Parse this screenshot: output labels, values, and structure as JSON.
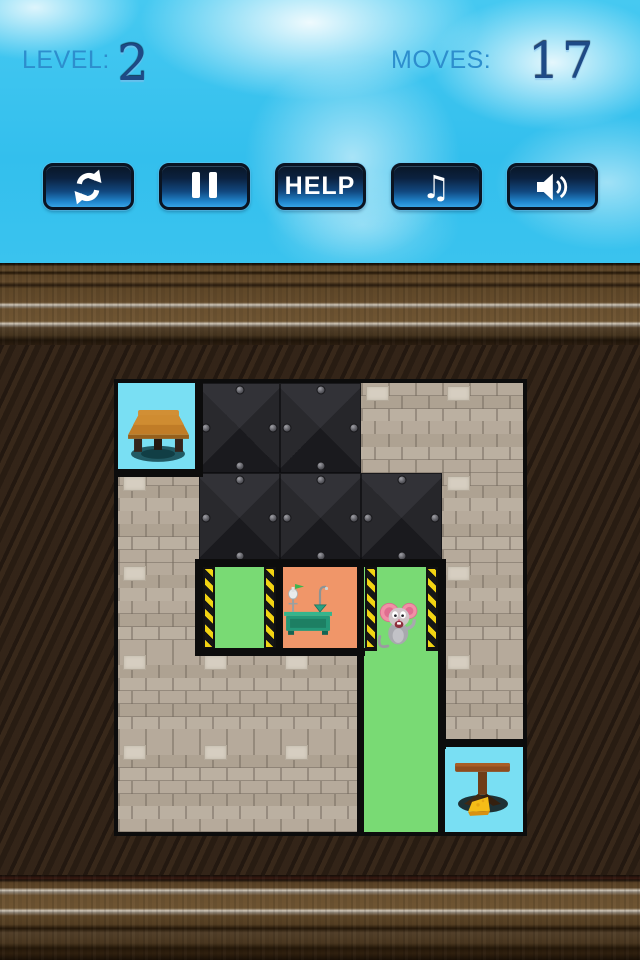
{
  "hud": {
    "level_label": "LEVEL:",
    "level_value": "2",
    "moves_label": "MOVES:",
    "moves_value": "17"
  },
  "toolbar": {
    "help_label": "HELP",
    "music_glyph": "♫",
    "buttons": [
      "restart",
      "pause",
      "help",
      "music",
      "sound"
    ]
  },
  "colors": {
    "sky": "#3cc4ee",
    "button_blue": "#2187cf",
    "button_dark": "#0a1626",
    "hud_label_blue": "#2d8ecd",
    "hud_number_blue": "#1e4a86",
    "brick_tan": "#b3a698",
    "metal_dark": "#232327",
    "room_green": "#79da74",
    "hazard_yellow": "#f2d312",
    "room_orange": "#f09669",
    "goal_cyan": "#79dff3",
    "wood_brown": "#5f4728",
    "wood_dark": "#2f2217"
  },
  "board": {
    "cols": 5,
    "rows": 5,
    "grid": [
      [
        "cyan",
        "metal",
        "metal",
        "brick",
        "brick"
      ],
      [
        "brick",
        "metal",
        "metal",
        "metal",
        "brick"
      ],
      [
        "brick",
        "greenh",
        "orange",
        "greenh",
        "brick"
      ],
      [
        "brick",
        "brick",
        "brick",
        "green",
        "brick"
      ],
      [
        "brick",
        "brick",
        "brick",
        "green",
        "cyan"
      ]
    ],
    "interactable_types": [
      "green",
      "greenh",
      "orange"
    ],
    "walls": [
      [
        77,
        0,
        8,
        90
      ],
      [
        0,
        86,
        85,
        8
      ],
      [
        77,
        176,
        251,
        8
      ],
      [
        77,
        176,
        8,
        97
      ],
      [
        77,
        265,
        170,
        8
      ],
      [
        158,
        178,
        7,
        95
      ],
      [
        239,
        178,
        7,
        95
      ],
      [
        320,
        176,
        8,
        190
      ],
      [
        239,
        265,
        7,
        184
      ],
      [
        320,
        356,
        85,
        8
      ],
      [
        320,
        356,
        7,
        93
      ]
    ],
    "items": [
      {
        "type": "bench-table",
        "row": 0,
        "col": 0,
        "name": "start-goal-table"
      },
      {
        "type": "lab-bench",
        "row": 2,
        "col": 2,
        "name": "lab-bench"
      },
      {
        "type": "mouse",
        "row": 2,
        "col": 3,
        "name": "mouse-character"
      },
      {
        "type": "cheese-table",
        "row": 4,
        "col": 4,
        "name": "cheese-goal-table"
      }
    ]
  }
}
